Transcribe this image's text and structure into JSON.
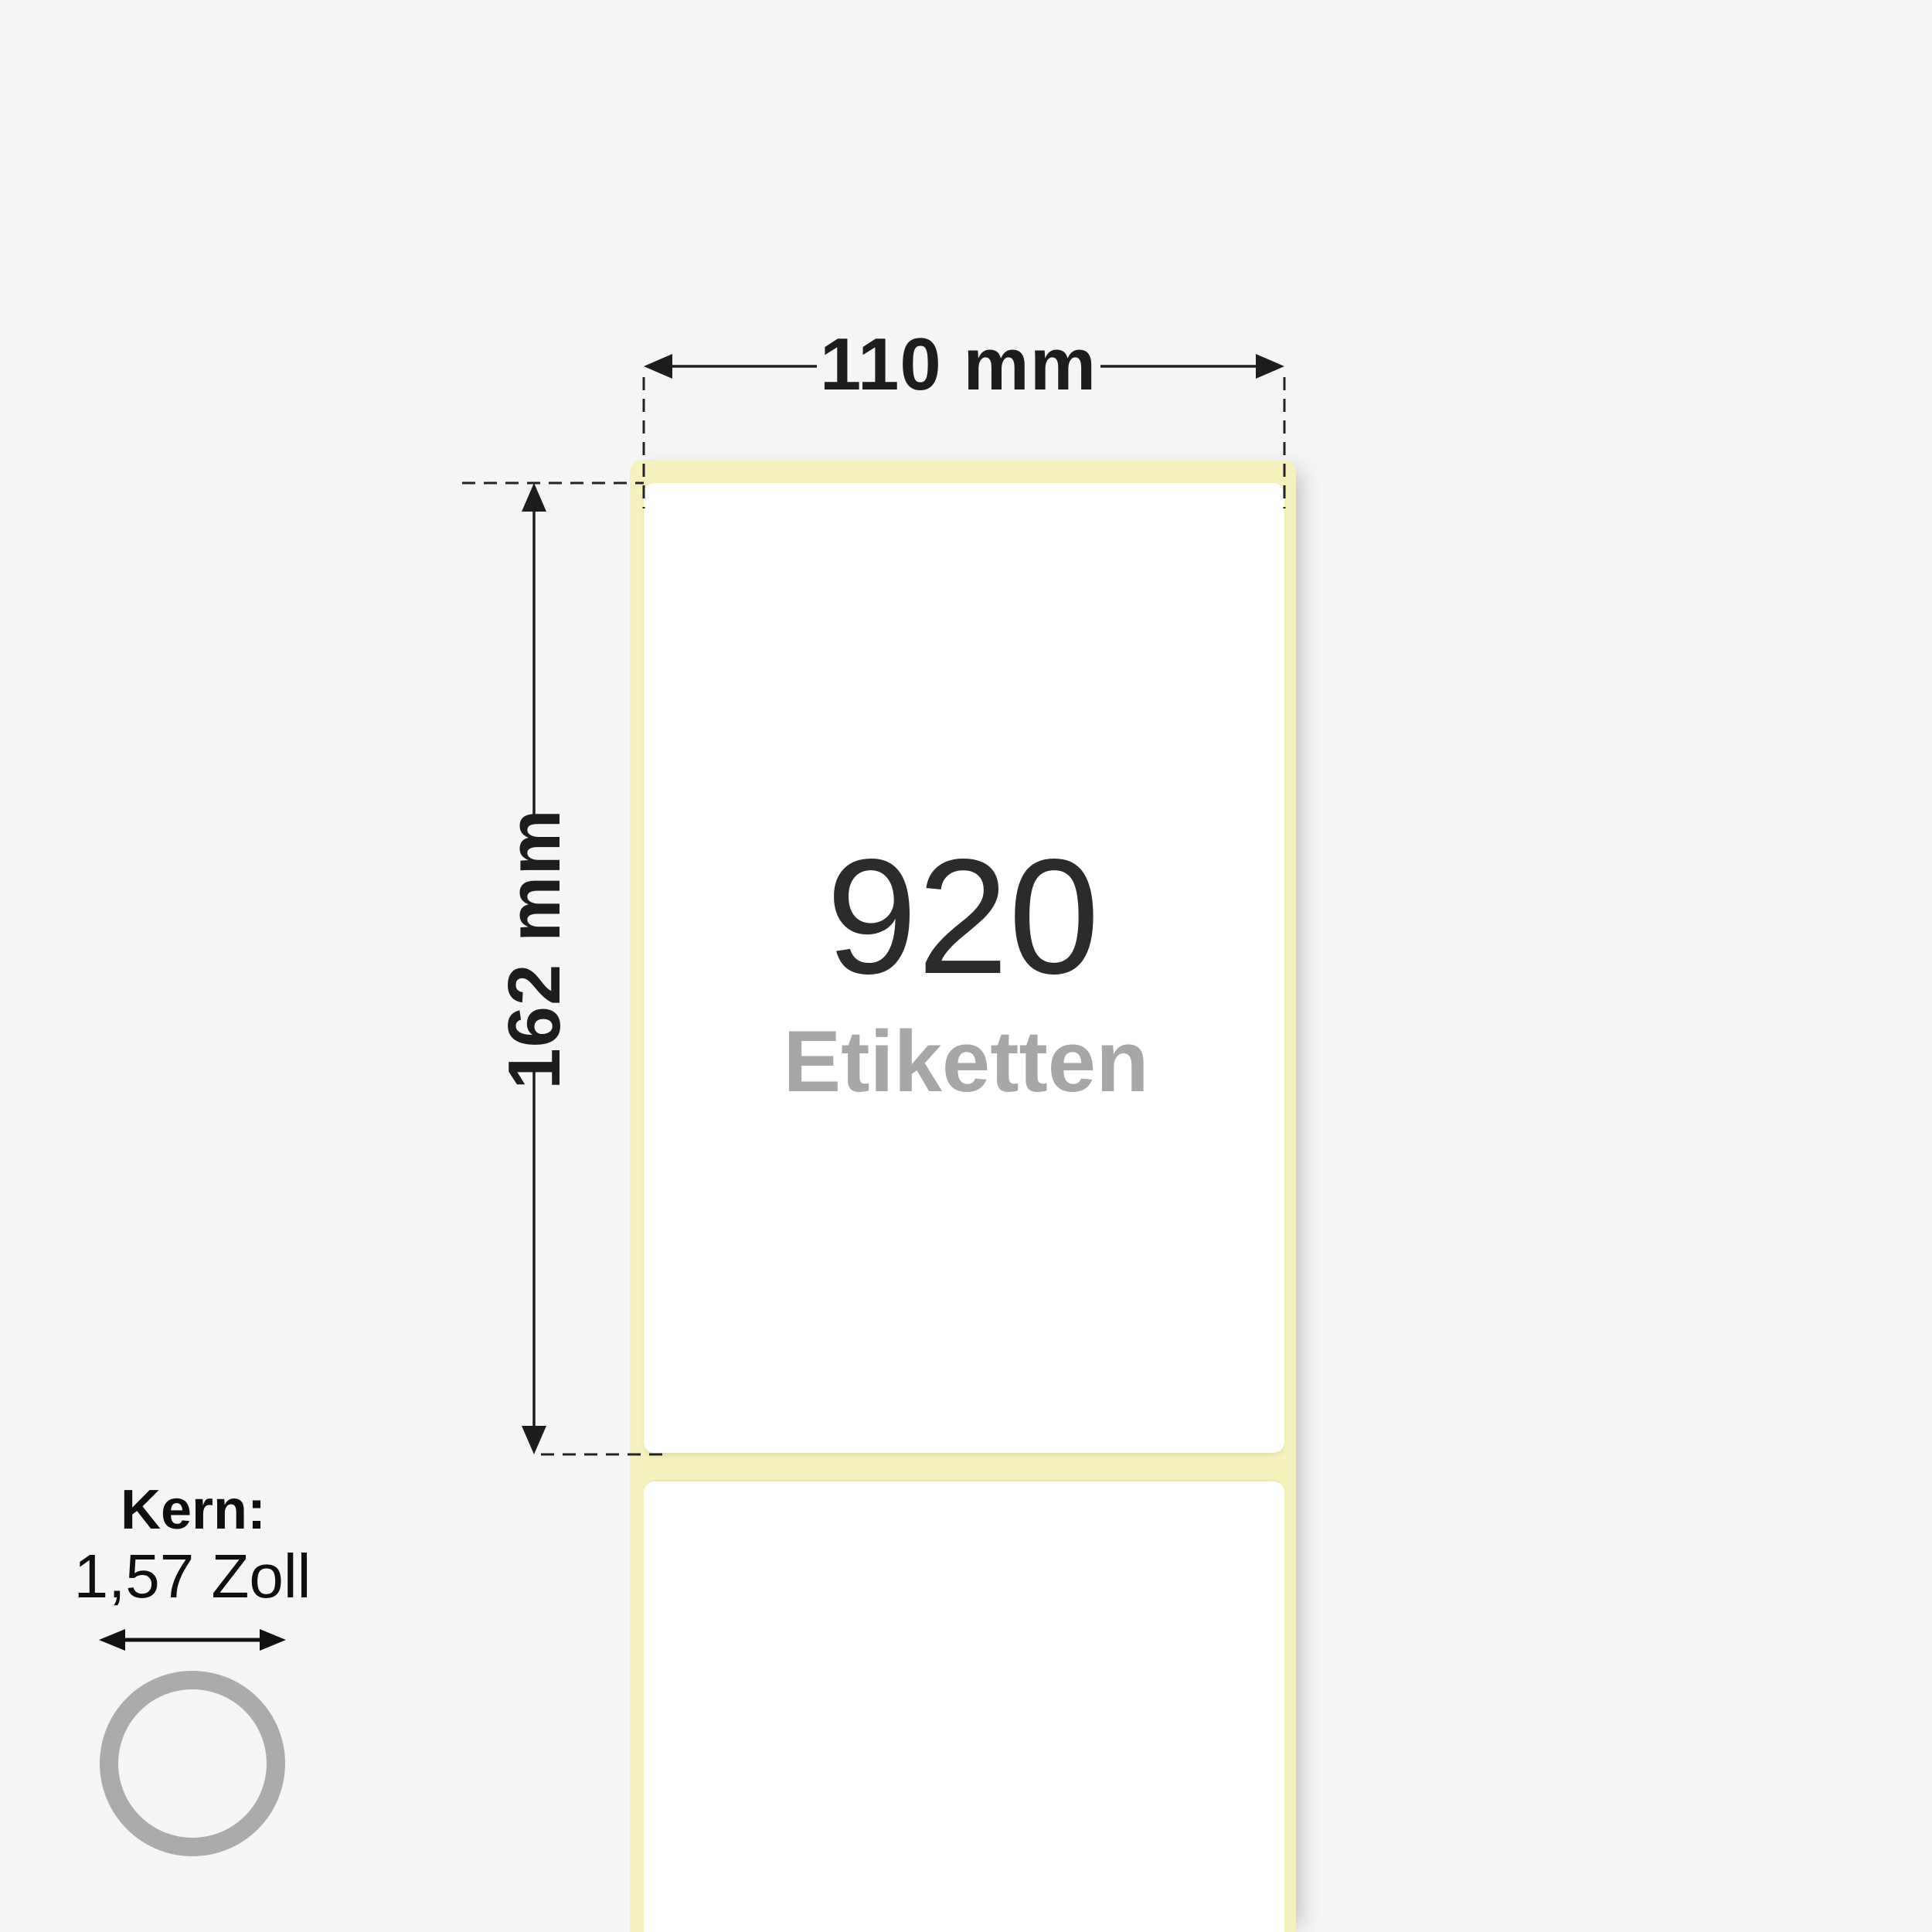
{
  "diagram": {
    "title": "Label roll dimension diagram",
    "width_dimension": "110 mm",
    "height_dimension": "162 mm",
    "label_count": "920",
    "label_count_unit": "Etiketten",
    "core": {
      "title": "Kern:",
      "size": "1,57 Zoll"
    }
  },
  "icons": {
    "core_ring": "ring-icon",
    "width_dimension_arrows": "horizontal-double-arrow-icon",
    "height_dimension_arrows": "vertical-double-arrow-icon",
    "core_diameter_arrow": "horizontal-double-arrow-icon"
  },
  "colors": {
    "bg": "#f5f5f6",
    "liner": "#f5f1bc",
    "label": "#ffffff",
    "ink": "#1d1d1d",
    "count": "#2b2b2b",
    "count-unit": "#a7a7a7",
    "ring": "#ababab"
  }
}
